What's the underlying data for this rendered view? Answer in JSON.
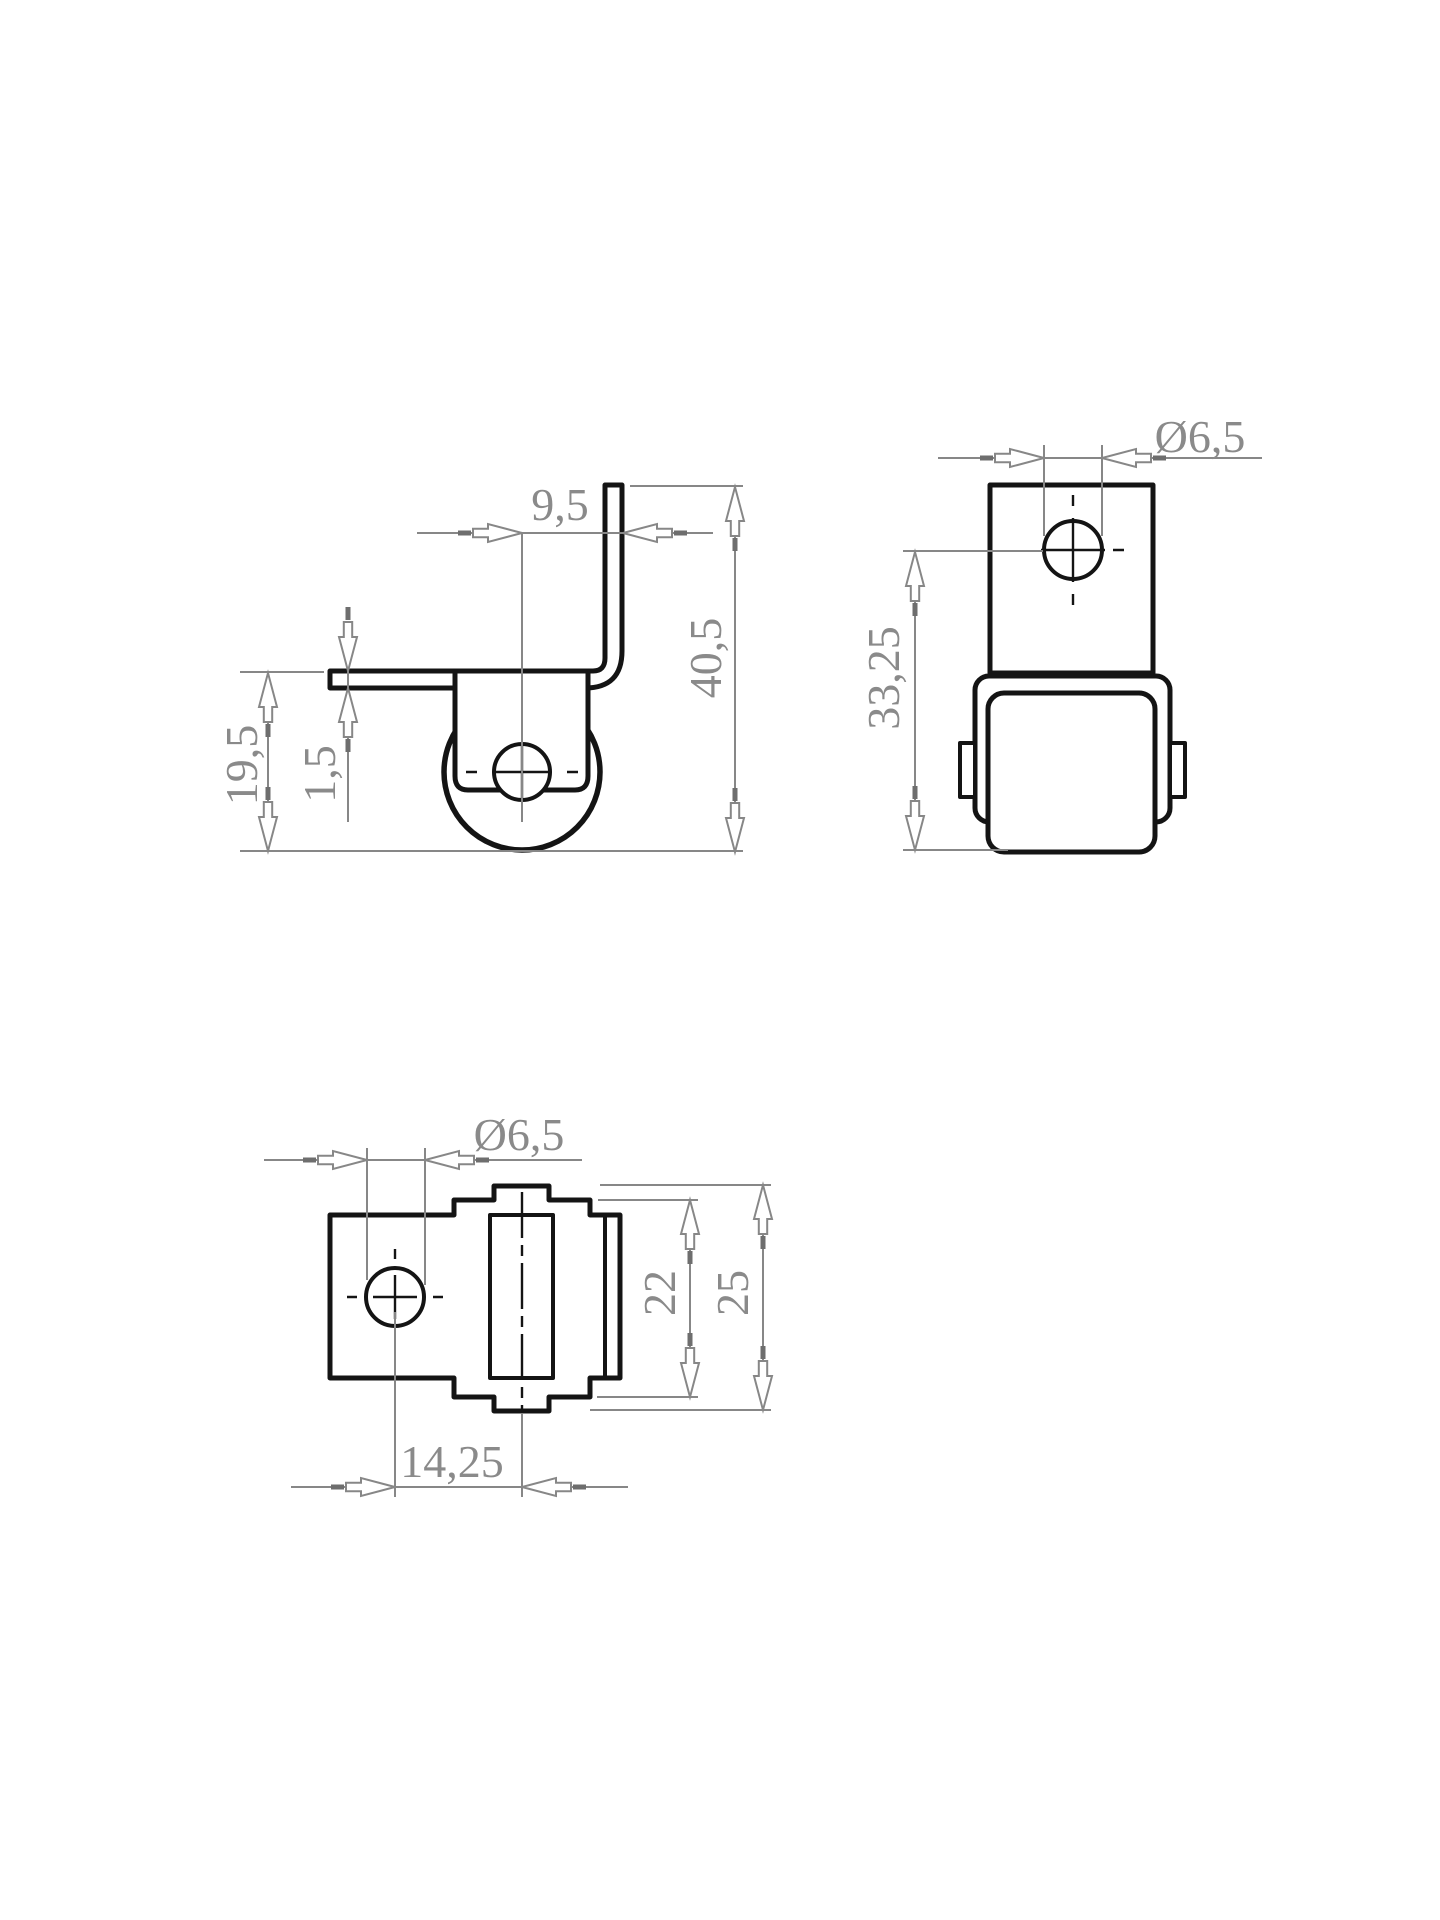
{
  "dims": {
    "side": {
      "flange_offset": "9,5",
      "overall_height": "40,5",
      "wheel_unit_height": "19,5",
      "plate_thickness": "1,5"
    },
    "front": {
      "hole_diameter": "Ø6,5",
      "axle_to_wheel_bottom": "33,25"
    },
    "top": {
      "hole_diameter": "Ø6,5",
      "fork_width": "22",
      "overall_width": "25",
      "hole_to_wheel_axis": "14,25"
    }
  },
  "colors": {
    "geometry": "#141414",
    "dimension_lines": "#878787",
    "dimension_text": "#8a8a8a",
    "background": "#ffffff"
  }
}
